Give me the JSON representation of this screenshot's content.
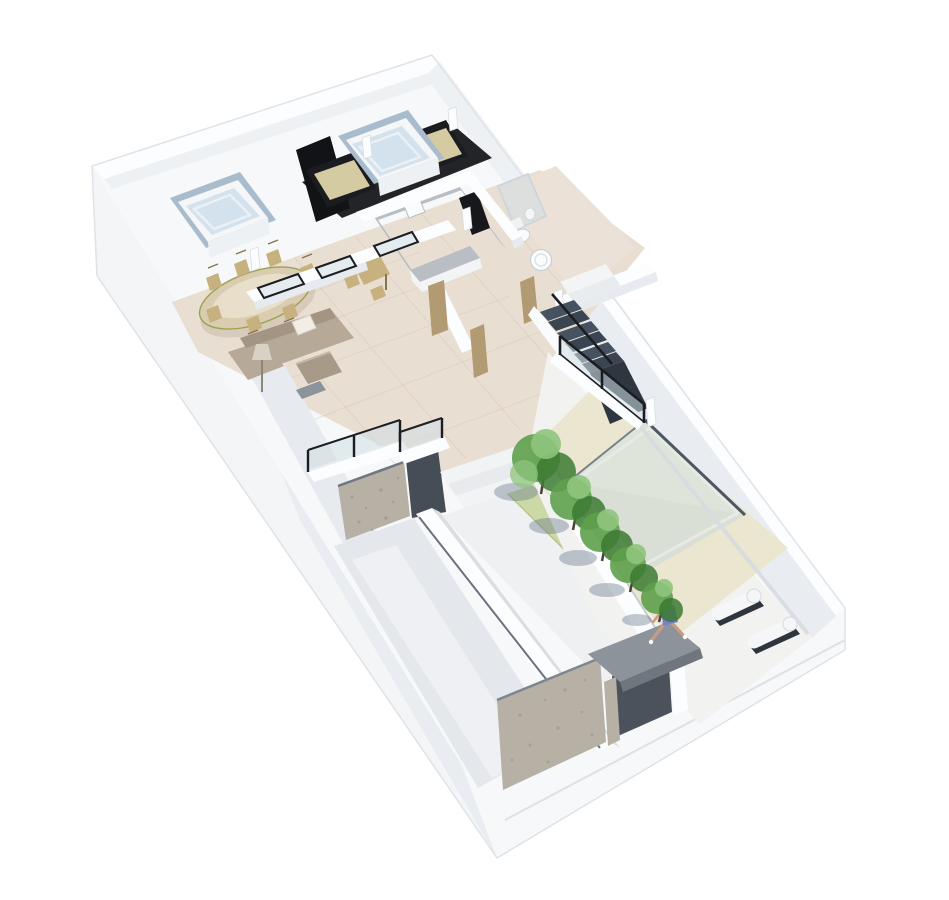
{
  "meta": {
    "type": "3d-isometric-floor-plan-render",
    "subject": "duplex apartment upper level with roof terrace, pool courtyard, garden ramp and entrance gate",
    "background": "#ffffff",
    "no_visible_text": true
  },
  "scene": {
    "rooms": [
      "roof-terrace",
      "bedroom",
      "kitchen",
      "bathroom",
      "dining-room",
      "living-room",
      "hallway",
      "staircase",
      "terrace",
      "garage-ramp",
      "garden-path",
      "tree-garden",
      "pool-courtyard",
      "entrance-gate"
    ],
    "objects": {
      "roof": [
        "skylight-box-small",
        "skylight-box-large"
      ],
      "bedroom": [
        "black-wardrobe",
        "sofa-left",
        "sofa-right",
        "dark-floor"
      ],
      "dining": [
        "oval-table",
        "six-chairs",
        "sliding-glass-doors"
      ],
      "living": [
        "l-shaped-sofa",
        "white-pillow",
        "coffee-table",
        "floor-lamp",
        "tv-console"
      ],
      "kitchen": [
        "u-shaped-counter",
        "cooktop",
        "sink",
        "breakfast-table",
        "two-chairs"
      ],
      "bathroom": [
        "shower",
        "toilet",
        "round-basin"
      ],
      "outdoor": [
        "dark-stairs",
        "glass-balustrades",
        "concrete-retaining-wall",
        "garage-ramp",
        "garden-steps",
        "five-trees",
        "grass-strip",
        "pool",
        "cream-pool-deck",
        "two-loungers",
        "seated-woman",
        "gray-gate-canopy",
        "concrete-wall-panel"
      ]
    }
  },
  "colors": {
    "page_bg": "#ffffff",
    "top_plane": "#f7f8f9",
    "outer_face_sw": "#f3f5f7",
    "outer_face_sw_dark": "#e9edf1",
    "outer_face_se": "#f6f8fa",
    "wall_top": "#fcfdfe",
    "wall_face": "#e7eaee",
    "wall_face_dark": "#d9dee3",
    "nw_band_face": "#eef1f4",
    "ne_inner_face": "#e9edf1",
    "tile_floor": "#e9ded2",
    "tile_grout": "#d5c6b7",
    "bath_floor": "#ece1d7",
    "dark_floor": "#17181c",
    "wardrobe": "#121317",
    "sofa_frame_black": "#1b1c20",
    "bed_cushion": "#d5cba3",
    "glass_sky": "#d4e2ed",
    "glass_sky_hi": "#e9f1f7",
    "sky_recess": "#a9bccd",
    "sky_box": "#f4f6f8",
    "dining_table": "#d9ccb1",
    "table_edge": "#8f8661",
    "chair_wood": "#c7b27f",
    "chair_dark": "#857448",
    "sofa_taupe": "#b7a997",
    "sofa_taupe_dark": "#a39484",
    "pillow": "#f2eee6",
    "coffee_table": "#a79a89",
    "lamp": "#d8d1c4",
    "tv_gray": "#8b949d",
    "counter_top": "#b9bdc4",
    "counter_face": "#f3f4f6",
    "cooktop": "#17181c",
    "stair_dark": "#46525f",
    "stair_dark2": "#3a4551",
    "stair_riser": "#2e3640",
    "glass_pane": "#cfdfe4",
    "glass_frame": "#1b1d21",
    "ramp": "#e4e8ec",
    "ramp_bright": "#eef0f3",
    "concrete": "#b6b0a5",
    "concrete_dark": "#8f887b",
    "slot_dark": "#454d57",
    "path": "#eef0f2",
    "grass": "#ccd8a6",
    "grass_dark": "#b7c68e",
    "tree_dark": "#3c7a33",
    "tree_mid": "#5ea04b",
    "tree_light": "#8fc47c",
    "tree_shadow": "#5f7086",
    "court_floor": "#f2f3f1",
    "pool_deck": "#eae6cf",
    "pool_water": "#dfe4da",
    "pool_deep": "#d6dcd2",
    "pool_edge": "#4d5862",
    "pool_edge_soft": "#76828a",
    "lounge_white": "#f5f6f8",
    "lounge_dark": "#2e353d",
    "skin": "#c79e85",
    "swimsuit": "#7b7fd4",
    "hair_gray": "#9aa0a6",
    "gate_canopy": "#8d939a",
    "gate_canopy_dark": "#70767e",
    "gate_shadow": "#4b525c",
    "door_tan": "#b29a72",
    "seam": "#d8dce0",
    "outline": "#dfe3e8"
  }
}
